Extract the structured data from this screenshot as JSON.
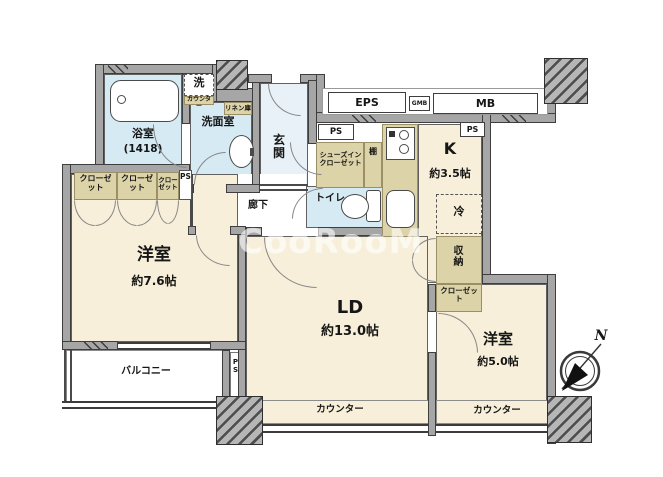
{
  "watermark": "CooRooM",
  "compass": {
    "north_label": "N"
  },
  "colors": {
    "floor_cream": "#f7efd9",
    "wet_area_blue": "#d6eaf4",
    "closet_tan": "#ddd3a8",
    "wall_gray": "#a6a6a6"
  },
  "rooms": {
    "bath": {
      "name": "浴室",
      "size": "(1418)"
    },
    "washroom": {
      "name": "洗面室"
    },
    "washer": {
      "name": "洗",
      "counter": "カウンター"
    },
    "linen": {
      "name": "リネン庫"
    },
    "entrance": {
      "name": "玄関"
    },
    "corridor": {
      "name": "廊下"
    },
    "shoe_closet": {
      "name": "シューズインクローゼット"
    },
    "shelf": {
      "name": "棚"
    },
    "toilet": {
      "name": "トイレ"
    },
    "kitchen": {
      "name": "K",
      "size": "約3.5帖"
    },
    "fridge": {
      "name": "冷"
    },
    "storage": {
      "name": "収納"
    },
    "closet_right": {
      "name": "クローゼット"
    },
    "western_7_6": {
      "name": "洋室",
      "size": "約7.6帖"
    },
    "living_dining": {
      "name": "LD",
      "size": "約13.0帖"
    },
    "western_5_0": {
      "name": "洋室",
      "size": "約5.0帖"
    },
    "balcony": {
      "name": "バルコニー"
    },
    "counter_ld": {
      "name": "カウンター"
    },
    "counter_w2": {
      "name": "カウンター"
    },
    "closets_left": [
      {
        "name": "クローゼット"
      },
      {
        "name": "クローゼット"
      },
      {
        "name": "クローゼット"
      }
    ]
  },
  "service": {
    "eps": "EPS",
    "gmb": "GMB",
    "mb": "MB",
    "ps_top_left": "PS",
    "ps_top_right": "PS",
    "ps_closet": "PS",
    "ps_balcony": "PS"
  }
}
